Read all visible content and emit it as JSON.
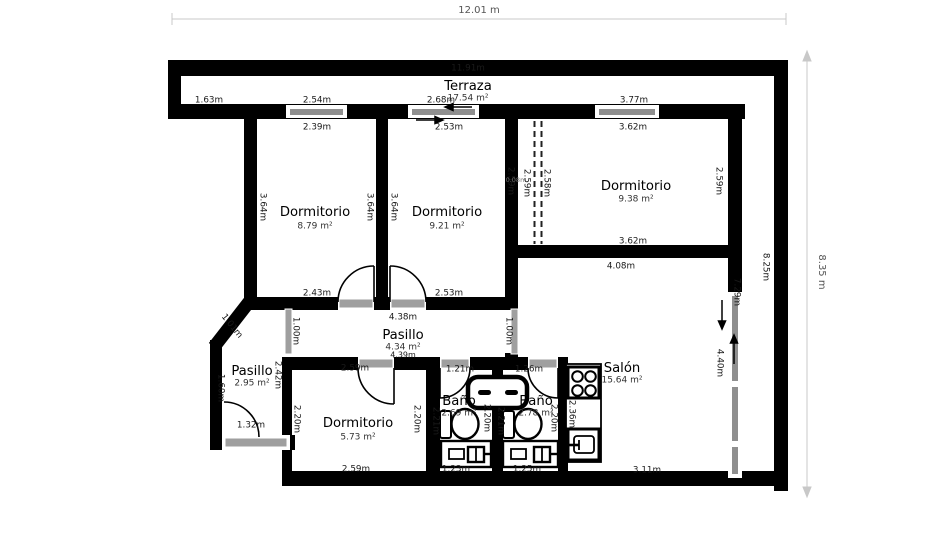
{
  "plan": {
    "overall_width_label": "12.01 m",
    "overall_height_label": "8.35 m"
  },
  "colors": {
    "wall": "#000000",
    "window": "#8f8f8f",
    "door": "#9f9f9f",
    "dim_line": "#c8c8c8",
    "dim_text": "#555555",
    "text": "#1a1a1a",
    "area_text": "#333333"
  },
  "rooms": [
    {
      "name": "Terraza",
      "area": "17.54 m²",
      "x": 468,
      "ny": 86,
      "ay": 98
    },
    {
      "name": "Dormitorio",
      "area": "8.79 m²",
      "x": 315,
      "ny": 212,
      "ay": 226
    },
    {
      "name": "Dormitorio",
      "area": "9.21 m²",
      "x": 447,
      "ny": 212,
      "ay": 226
    },
    {
      "name": "Dormitorio",
      "area": "9.38 m²",
      "x": 636,
      "ny": 186,
      "ay": 199
    },
    {
      "name": "Pasillo",
      "area": "4.34 m²",
      "x": 403,
      "ny": 335,
      "ay": 347
    },
    {
      "name": "Pasillo",
      "area": "2.95 m²",
      "x": 252,
      "ny": 371,
      "ay": 383
    },
    {
      "name": "Dormitorio",
      "area": "5.73 m²",
      "x": 358,
      "ny": 423,
      "ay": 437
    },
    {
      "name": "Baño",
      "area": "2.69 m²",
      "x": 459,
      "ny": 401,
      "ay": 413
    },
    {
      "name": "Baño",
      "area": "2.78 m²",
      "x": 536,
      "ny": 401,
      "ay": 413
    },
    {
      "name": "Salón",
      "area": "15.64 m²",
      "x": 622,
      "ny": 368,
      "ay": 380
    }
  ],
  "measurements": [
    {
      "t": "12.01 m",
      "x": 479,
      "y": 10,
      "s": 10,
      "c": "#555555"
    },
    {
      "t": "8.35 m",
      "x": 822,
      "y": 272,
      "r": 90,
      "s": 10,
      "c": "#555555"
    },
    {
      "t": "11.91m",
      "x": 468,
      "y": 68
    },
    {
      "t": "1.63m",
      "x": 209,
      "y": 100
    },
    {
      "t": "2.54m",
      "x": 317,
      "y": 100
    },
    {
      "t": "2.68m",
      "x": 441,
      "y": 100
    },
    {
      "t": "3.77m",
      "x": 634,
      "y": 100
    },
    {
      "t": "2.39m",
      "x": 317,
      "y": 127
    },
    {
      "t": "2.53m",
      "x": 449,
      "y": 127
    },
    {
      "t": "3.62m",
      "x": 633,
      "y": 127
    },
    {
      "t": "3.64m",
      "x": 263,
      "y": 207,
      "r": 90
    },
    {
      "t": "3.64m",
      "x": 370,
      "y": 207,
      "r": 90
    },
    {
      "t": "3.64m",
      "x": 394,
      "y": 207,
      "r": 90
    },
    {
      "t": "2.59m",
      "x": 511,
      "y": 181,
      "r": 90
    },
    {
      "t": "0.08m",
      "x": 516,
      "y": 180,
      "s": 6.5,
      "c": "#777777"
    },
    {
      "t": "2.59m",
      "x": 527,
      "y": 183,
      "r": 90
    },
    {
      "t": "2.58m",
      "x": 547,
      "y": 183,
      "r": 90
    },
    {
      "t": "2.59m",
      "x": 719,
      "y": 181,
      "r": 90
    },
    {
      "t": "2.43m",
      "x": 317,
      "y": 293
    },
    {
      "t": "2.53m",
      "x": 449,
      "y": 293
    },
    {
      "t": "3.62m",
      "x": 633,
      "y": 241
    },
    {
      "t": "4.08m",
      "x": 621,
      "y": 266
    },
    {
      "t": "4.38m",
      "x": 403,
      "y": 317
    },
    {
      "t": "4.39m",
      "x": 403,
      "y": 355,
      "s": 8
    },
    {
      "t": "1.00m",
      "x": 296,
      "y": 331,
      "r": 90
    },
    {
      "t": "1.00m",
      "x": 509,
      "y": 331,
      "r": 90
    },
    {
      "t": "1.01m",
      "x": 232,
      "y": 326,
      "r": 51
    },
    {
      "t": "2.42m",
      "x": 278,
      "y": 375,
      "r": 90
    },
    {
      "t": "1.60m",
      "x": 221,
      "y": 388,
      "r": 90
    },
    {
      "t": "1.32m",
      "x": 251,
      "y": 425
    },
    {
      "t": "2.59m",
      "x": 355,
      "y": 368
    },
    {
      "t": "2.20m",
      "x": 297,
      "y": 419,
      "r": 90
    },
    {
      "t": "2.20m",
      "x": 417,
      "y": 419,
      "r": 90
    },
    {
      "t": "2.59m",
      "x": 356,
      "y": 469
    },
    {
      "t": "1.21m",
      "x": 460,
      "y": 369
    },
    {
      "t": "2.21m",
      "x": 436,
      "y": 421,
      "r": 90
    },
    {
      "t": "2.20m",
      "x": 487,
      "y": 418,
      "r": 90
    },
    {
      "t": "1.23m",
      "x": 456,
      "y": 469
    },
    {
      "t": "1.26m",
      "x": 529,
      "y": 369
    },
    {
      "t": "2.21m",
      "x": 501,
      "y": 421,
      "r": 90
    },
    {
      "t": "2.20m",
      "x": 554,
      "y": 418,
      "r": 90
    },
    {
      "t": "1.25m",
      "x": 527,
      "y": 469
    },
    {
      "t": "2.36m",
      "x": 572,
      "y": 414,
      "r": 90
    },
    {
      "t": "3.11m",
      "x": 647,
      "y": 470
    },
    {
      "t": "7.29m",
      "x": 737,
      "y": 292,
      "r": 90
    },
    {
      "t": "4.40m",
      "x": 720,
      "y": 363,
      "r": 90
    },
    {
      "t": "8.25m",
      "x": 766,
      "y": 267,
      "r": 90
    }
  ]
}
